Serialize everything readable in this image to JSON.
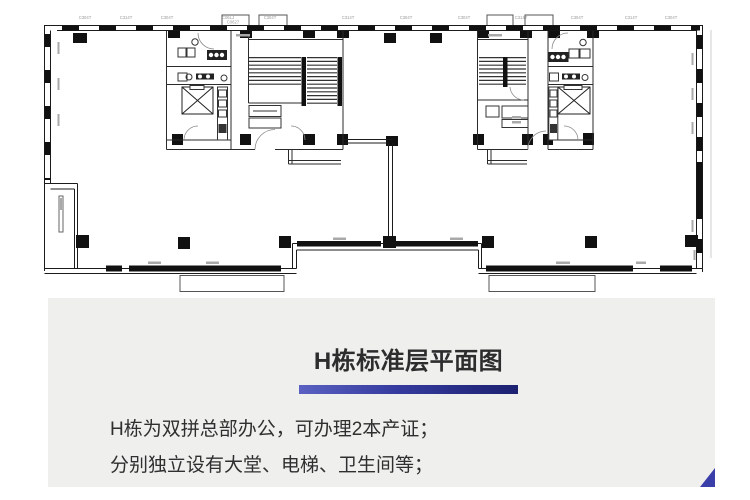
{
  "page": {
    "background": "#ffffff"
  },
  "floor_plan": {
    "name": "building-h-standard-floor-plan",
    "colors": {
      "wall": "#111111",
      "thin_line": "#1b1b1b",
      "dim_text": "#9a9a9a"
    },
    "top_dim_labels": [
      "C304T",
      "C314T",
      "C304T",
      "C06LJ",
      "C304T",
      "C314T",
      "C304T",
      "C304T",
      "C314T",
      "C304T",
      "C314T",
      "C304T",
      "C0627"
    ]
  },
  "panel": {
    "background": "#efefed",
    "title": "H栋标准层平面图",
    "accent_bar": {
      "gradient_start": "#5a61c2",
      "gradient_end": "#1c2170"
    },
    "body_lines": [
      "H栋为双拼总部办公，可办理2本产证；",
      "分别独立设有大堂、电梯、卫生间等；"
    ],
    "corner_accent_color": "#3a3ea9"
  }
}
